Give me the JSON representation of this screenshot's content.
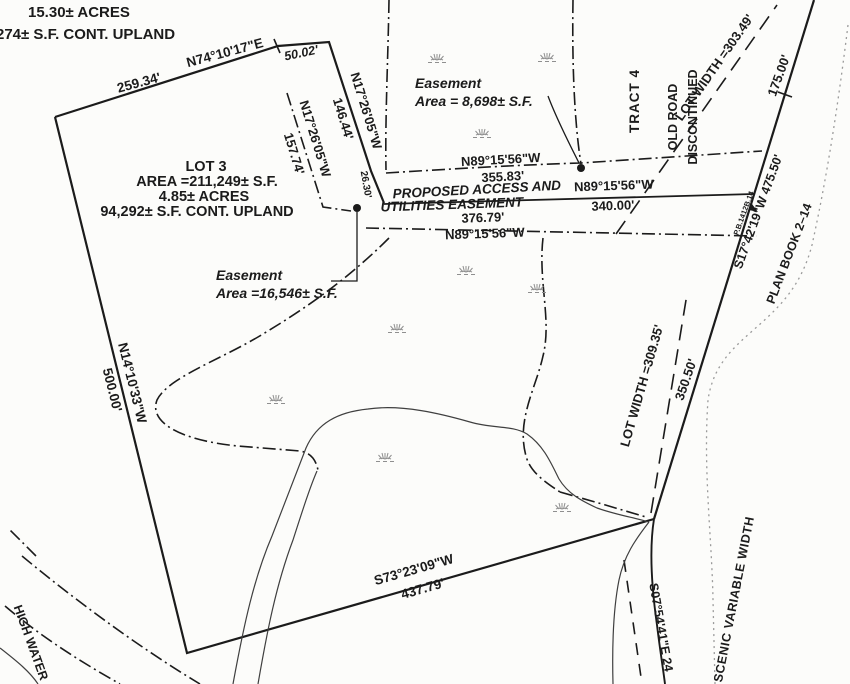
{
  "document": {
    "type": "survey-plat-scan",
    "colors": {
      "ink": "#1b1b1b",
      "paper": "#fcfcfa",
      "marsh": "#8f8f8f",
      "faint_line": "#9b9b9b",
      "stream": "#3f3f3f"
    }
  },
  "labels": {
    "acres_top": "15.30± ACRES",
    "upland_top": "274± S.F. CONT. UPLAND",
    "dist_259": "259.34'",
    "brg_n74": "N74°10'17\"E",
    "dist_5002": "50.02'",
    "brg_n17_a": "N17°26'05\"W",
    "dist_14644": "146.44'",
    "brg_n17_b": "N17°26'05\"W",
    "dist_15774": "157.74'",
    "dist_2630": "26.30'",
    "esmt1_line1": "Easement",
    "esmt1_line2": "Area = 8,698± S.F.",
    "tract4": "TRACT 4",
    "old_road_1": "OLD ROAD",
    "old_road_2": "DISCONTINUED",
    "lot_width_top": "LOT WIDTH =303.49'",
    "dist_175": "175.00'",
    "brg_n89_a": "N89°15'56\"W",
    "dist_35583": "355.83'",
    "proposed_1": "PROPOSED ACCESS AND",
    "proposed_2": "UTILITIES EASEMENT",
    "brg_n89_b": "N89°15'56\"W",
    "dist_340": "340.00'",
    "dist_37679": "376.79'",
    "brg_n89_c": "N89°15'56\"W",
    "lot3_title": "LOT 3",
    "lot3_area": "AREA =211,249± S.F.",
    "lot3_acres": "4.85± ACRES",
    "lot3_upland": "94,292± S.F. CONT. UPLAND",
    "esmt2_line1": "Easement",
    "esmt2_line2": "Area =16,546± S.F.",
    "brg_n14": "N14°10'33\"W",
    "dist_500": "500.00'",
    "lot_width_bot": "LOT WIDTH =309.35'",
    "dist_35050": "350.50'",
    "brg_s73": "S73°23'09\"W",
    "dist_43779": "437.79'",
    "brg_s17": "S17°42'19\"W  475.50'",
    "ref_small": "P.B.1412B.14",
    "plan_book": "PLAN BOOK 2–14",
    "brg_s07": "S07°54'41\"E  24",
    "scenic": "SCENIC  VARIABLE  WIDTH",
    "high_water": "HIGH WATER"
  },
  "icons": {
    "marsh": "marsh-wetland-symbol"
  }
}
